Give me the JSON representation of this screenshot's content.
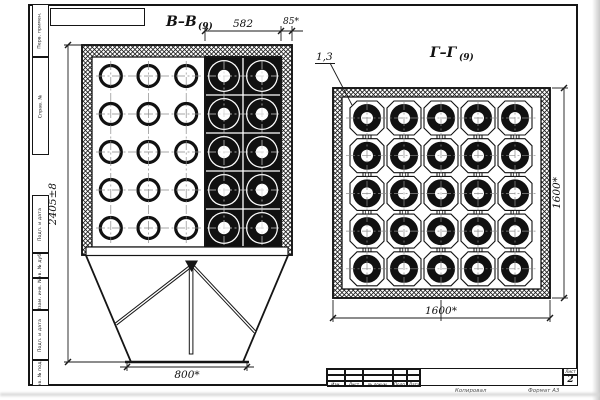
{
  "sheet": {
    "sheet_number_label": "Лист",
    "sheet_number": "2",
    "below_frame": {
      "copied": "Копировал",
      "format": "Формат А3"
    },
    "margin_labels": [
      "Перв. примен.",
      "Справ. №",
      "Подп. и дата",
      "Инв. № дубл.",
      "Взам. инв. №",
      "Подп. и дата",
      "Инв. № подл."
    ],
    "title_block_headers": [
      "Изм.",
      "Лист",
      "№ докум.",
      "Подп.",
      "Дата"
    ]
  },
  "views": {
    "bb": {
      "label": "В–В",
      "label_sub": "(9)",
      "dims": {
        "top_width": "582",
        "wall_thickness": "85*",
        "overall_height": "2405±8",
        "outlet_width": "800*"
      },
      "plain_grid": {
        "rows": 5,
        "cols": 3
      },
      "tube_grid": {
        "rows": 5,
        "cols": 2
      }
    },
    "gg": {
      "label": "Г–Г",
      "label_sub": "(9)",
      "callout": "1,3",
      "dims": {
        "width": "1600*",
        "height": "1600*"
      },
      "grid": {
        "rows": 5,
        "cols": 5
      }
    }
  }
}
